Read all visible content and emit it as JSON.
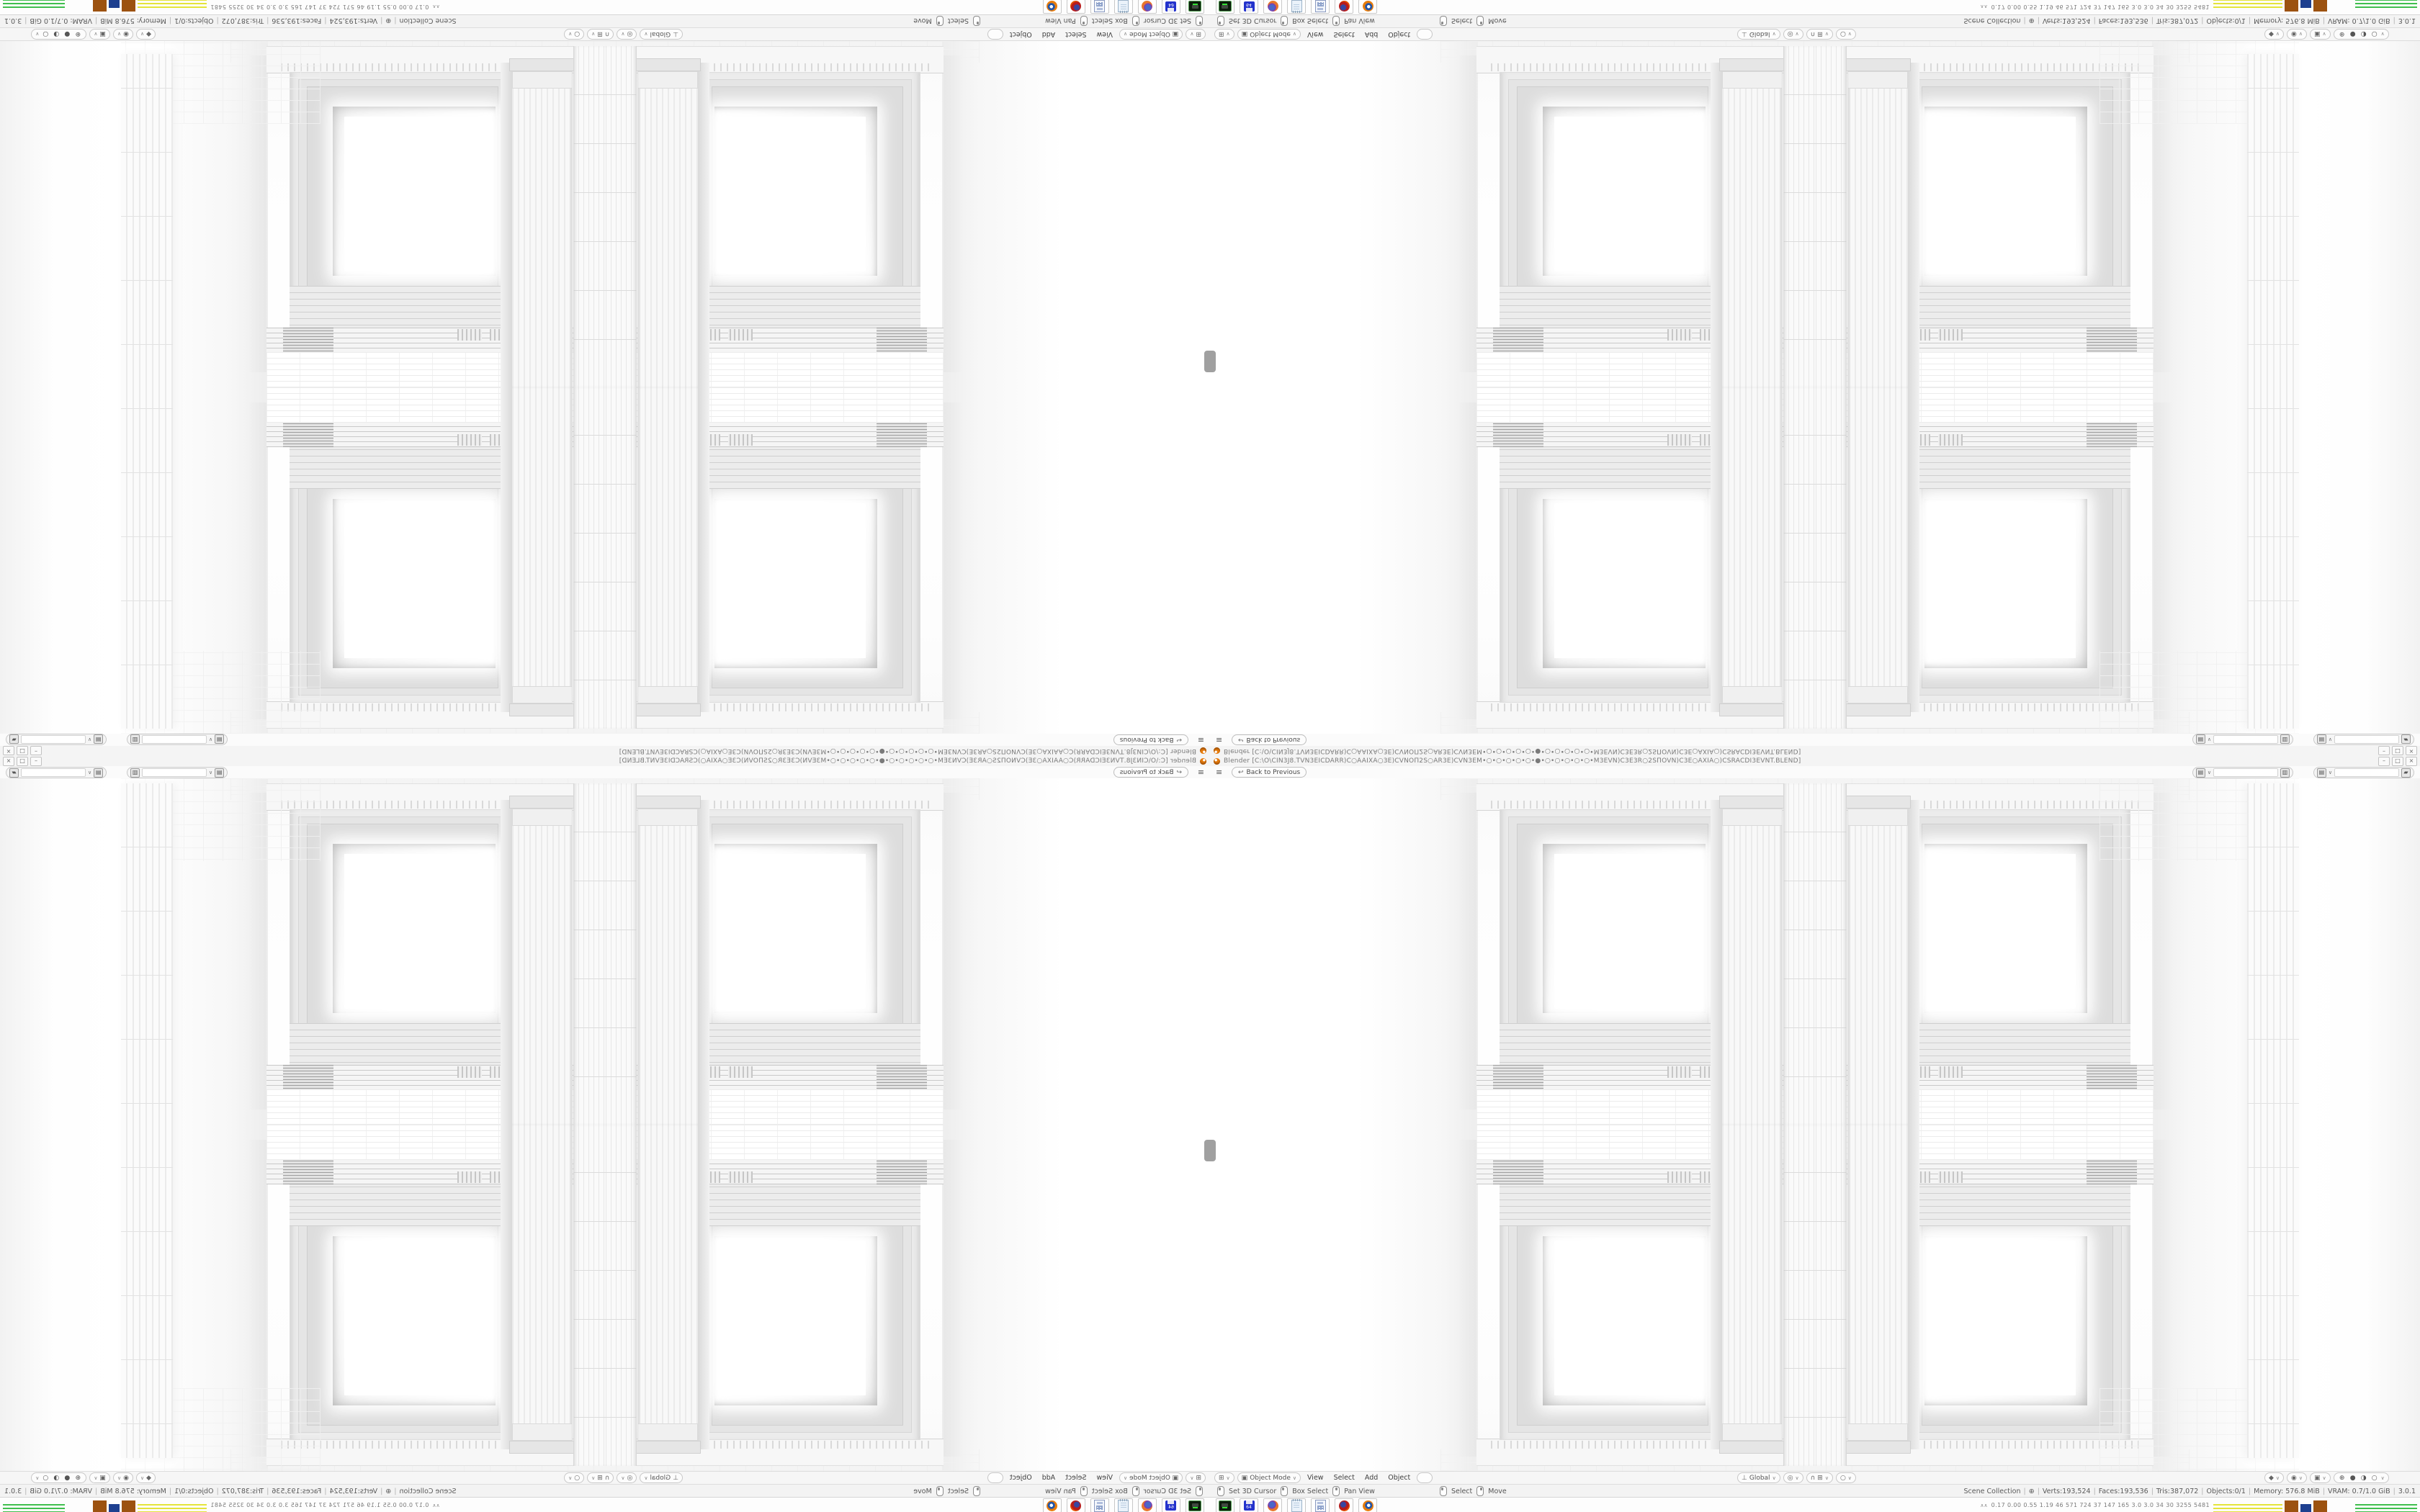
{
  "window": {
    "title": "Blender [C:\\O\\CIN3J8.TVN3EICDARR)C○AAIXA○3E)CVNOΠ2S○AR3E)CVN3EM•○•○•○•○•○•●•○•○•○•○•○•M3EVN)C3E3R○2SΠOVN)C3E○AXIA○)CSRACDI3EVNT.BLEND]",
    "minimize_glyph": "–",
    "maximize_glyph": "□",
    "close_glyph": "×"
  },
  "topbar": {
    "menu_icon": "≡",
    "back_icon": "↩",
    "back_label": "Back to Previous",
    "dropdown_glyph": "∨",
    "scene_icon": "▤",
    "scene_value": "",
    "scene_action_icon": "▥",
    "view_layer_icon": "▤",
    "view_layer_value": "",
    "view_layer_action_icon": "▰"
  },
  "header": {
    "editor_icon": "⊞",
    "mode_icon": "▣",
    "mode_label": "Object Mode",
    "dropdown_glyph": "∨",
    "menus": [
      "View",
      "Select",
      "Add",
      "Object"
    ],
    "orientation_icon": "⊥",
    "orientation_label": "Global",
    "pivot_icon": "◎",
    "snap_icon": "∩",
    "snap_extra_icon": "⊞",
    "proportional_icon": "○",
    "gizmo_icon": "◆",
    "overlays_icon": "◉",
    "xray_icon": "▣",
    "shading_icons": [
      "⊕",
      "●",
      "◑",
      "○"
    ]
  },
  "statusbar": {
    "hints": [
      "Set 3D Cursor",
      "Box Select",
      "Pan View",
      "Select",
      "Move"
    ],
    "sep": "|",
    "scene_label": "Scene Collection",
    "globe_icon": "⊕",
    "stats": [
      "Verts:193,524",
      "Faces:193,536",
      "Tris:387,072",
      "Objects:0/1",
      "Memory: 576.8 MiB",
      "VRAM: 0.7/1.0 GiB",
      "3.0.1"
    ]
  },
  "taskbar": {
    "apps": [
      "terminal",
      "floppy-64",
      "firefox",
      "text-editor",
      "calculator",
      "firefox-red",
      "blender"
    ],
    "floppy_label": "64",
    "monitor_icon": "∧∧",
    "monitor_values": "0.17 0.00 0.55 1.19  46  571  724  37  147  165  3.0  3.0  34  30  3255 5481"
  },
  "colors": {
    "blender_orange": "#e87d0d",
    "chart_yellow": "#e4e43a",
    "chart_brown": "#9c5210",
    "chart_navy": "#1d3f8f",
    "chart_green": "#3fbf4e"
  }
}
